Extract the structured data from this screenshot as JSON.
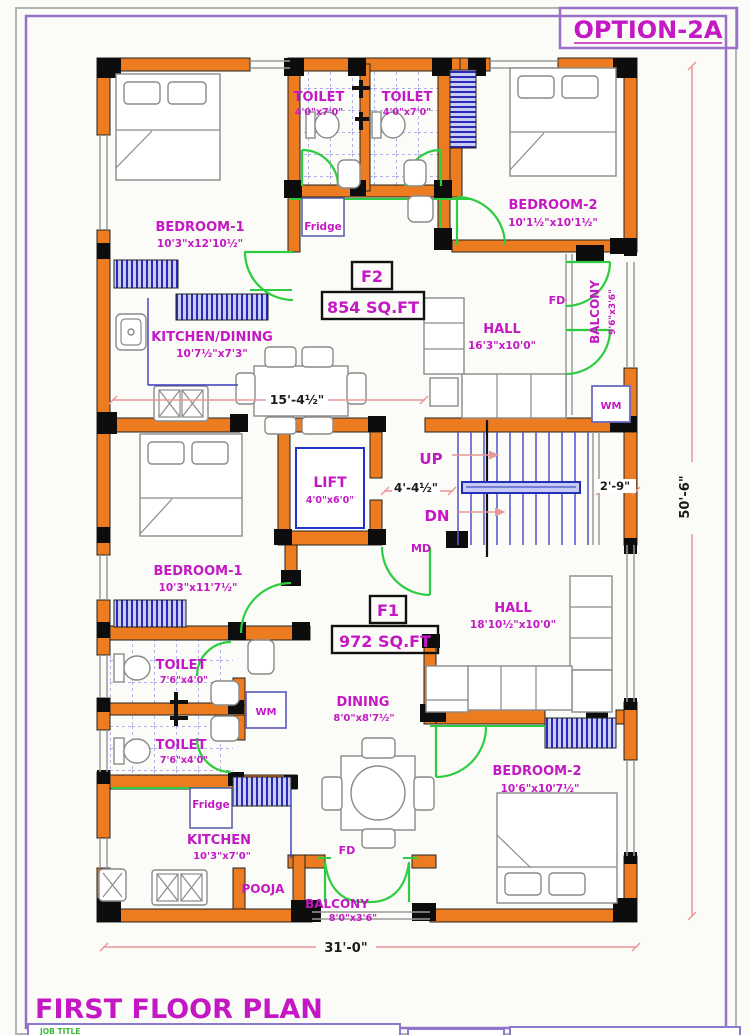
{
  "page": {
    "option_label": "OPTION-2A",
    "plan_title": "FIRST FLOOR PLAN",
    "job_title_label": "JOB TITLE"
  },
  "dimensions": {
    "overall_width": "31'-0\"",
    "overall_height": "50'-6\"",
    "kitchen_hall_span": "15'-4½\"",
    "stair_flight": "4'-4½\"",
    "stair_landing": "2'-9\""
  },
  "core": {
    "lift_name": "LIFT",
    "lift_dims": "4'0\"x6'0\"",
    "up_label": "UP",
    "dn_label": "DN",
    "md_label": "MD"
  },
  "flat_f2": {
    "id": "F2",
    "area": "854 SQ.FT",
    "bedroom1_name": "BEDROOM-1",
    "bedroom1_dims": "10'3\"x12'10½\"",
    "bedroom2_name": "BEDROOM-2",
    "bedroom2_dims": "10'1½\"x10'1½\"",
    "toilet1_name": "TOILET",
    "toilet1_dims": "4'0\"x7'0\"",
    "toilet2_name": "TOILET",
    "toilet2_dims": "4'0\"x7'0\"",
    "kitchen_name": "KITCHEN/DINING",
    "kitchen_dims": "10'7½\"x7'3\"",
    "hall_name": "HALL",
    "hall_dims": "16'3\"x10'0\"",
    "balcony_name": "BALCONY",
    "balcony_dims": "9'6\"x3'6\"",
    "fridge_label": "Fridge",
    "wm_label": "WM",
    "fd_label": "FD"
  },
  "flat_f1": {
    "id": "F1",
    "area": "972 SQ.FT",
    "bedroom1_name": "BEDROOM-1",
    "bedroom1_dims": "10'3\"x11'7½\"",
    "bedroom2_name": "BEDROOM-2",
    "bedroom2_dims": "10'6\"x10'7½\"",
    "toilet1_name": "TOILET",
    "toilet1_dims": "7'6\"x4'0\"",
    "toilet2_name": "TOILET",
    "toilet2_dims": "7'6\"x4'0\"",
    "kitchen_name": "KITCHEN",
    "kitchen_dims": "10'3\"x7'0\"",
    "dining_name": "DINING",
    "dining_dims": "8'0\"x8'7½\"",
    "hall_name": "HALL",
    "hall_dims": "18'10½\"x10'0\"",
    "balcony_name": "BALCONY",
    "balcony_dims": "8'0\"x3'6\"",
    "pooja_label": "POOJA",
    "fridge_label": "Fridge",
    "wm_label": "WM",
    "fd_label": "FD"
  },
  "colors": {
    "wall_orange": "#ED7C20",
    "label_magenta": "#C318C3",
    "door_green": "#2ECC40",
    "window_blue": "#2A2AB5",
    "dim_pink": "#E89898",
    "border_purple": "#9A6FC8"
  }
}
